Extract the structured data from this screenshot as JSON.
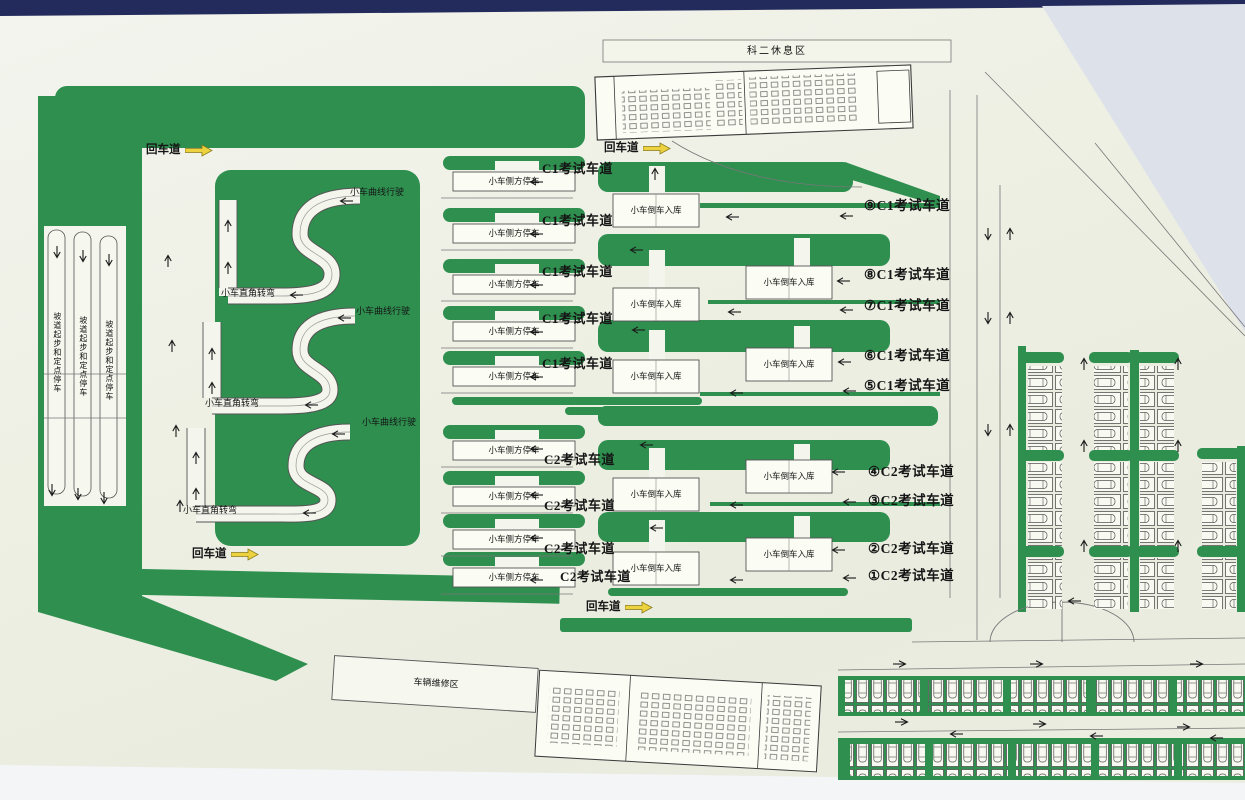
{
  "colors": {
    "green": "#2e8f4f",
    "board_cream": "#eef0e4",
    "navy_edge": "#232a5c",
    "arrow_yellow": "#ecd23f",
    "outline": "#555555"
  },
  "areas": {
    "rest_area": "科二休息区",
    "maintenance_area": "车辆维修区"
  },
  "roads": {
    "return_lane": "回车道"
  },
  "stations": {
    "curve_driving": "小车曲线行驶",
    "right_angle_turn": "小车直角转弯",
    "side_parking": "小车侧方停车",
    "reverse_garage": "小车倒车入库",
    "hill_start": "坡道起步和定点停车"
  },
  "lanes": {
    "c1": "C1考试车道",
    "c2": "C2考试车道",
    "numbered_c1": [
      "⑨C1考试车道",
      "⑧C1考试车道",
      "⑦C1考试车道",
      "⑥C1考试车道",
      "⑤C1考试车道"
    ],
    "numbered_c2": [
      "④C2考试车道",
      "③C2考试车道",
      "②C2考试车道",
      "①C2考试车道"
    ]
  }
}
